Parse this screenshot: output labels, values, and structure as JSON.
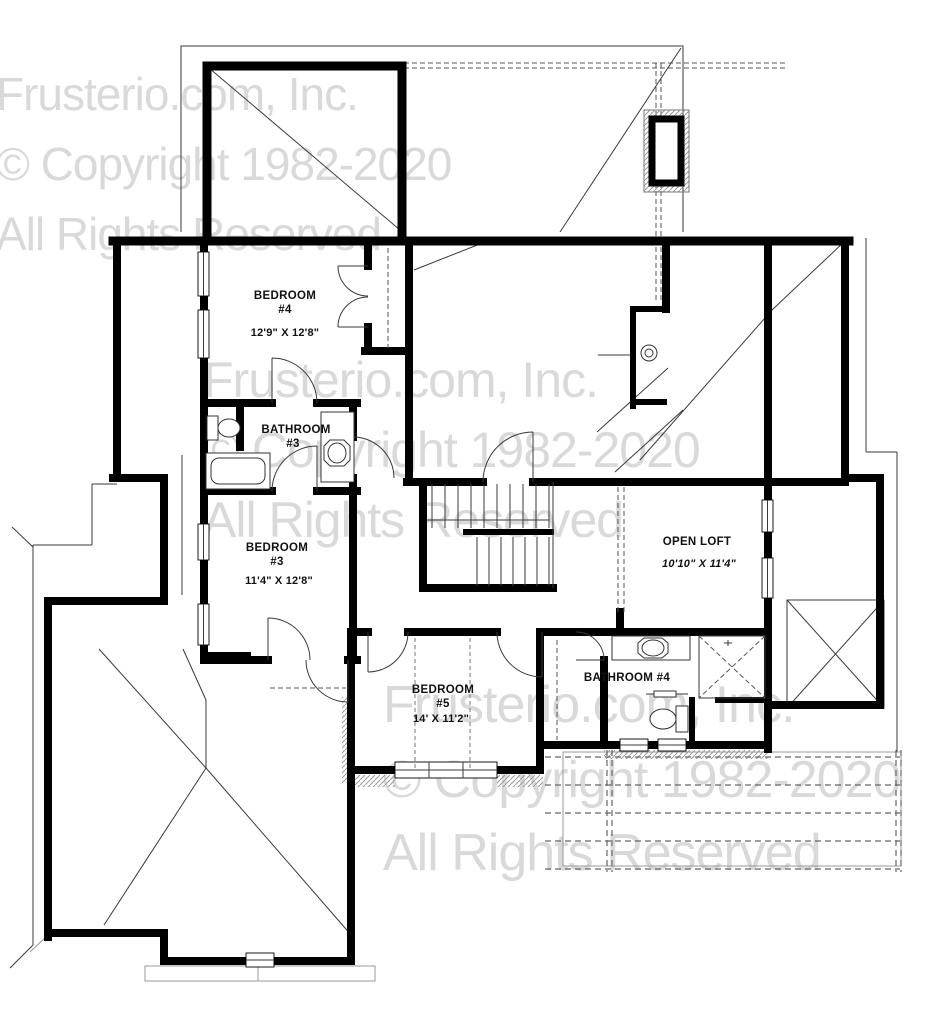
{
  "watermark": {
    "line1": "Frusterio.com, Inc.",
    "line2": "© Copyright 1982-2020",
    "line3": "All Rights Reserved",
    "color": "#d9d9d9"
  },
  "rooms": {
    "bedroom4": {
      "name_line1": "BEDROOM",
      "name_line2": "#4",
      "dims": "12'9\" X 12'8\""
    },
    "bathroom3": {
      "name_line1": "BATHROOM",
      "name_line2": "#3"
    },
    "bedroom3": {
      "name_line1": "BEDROOM",
      "name_line2": "#3",
      "dims": "11'4\" X 12'8\""
    },
    "open_loft": {
      "name_line1": "OPEN LOFT",
      "dims": "10'10\" X 11'4\""
    },
    "bathroom4": {
      "name_line1": "BATHROOM #4"
    },
    "bedroom5": {
      "name_line1": "BEDROOM",
      "name_line2": "#5",
      "dims": "14' X 11'2\""
    }
  },
  "colors": {
    "walls": "#000000",
    "thin_lines": "#3a3a3a",
    "watermark": "#d9d9d9",
    "background": "#ffffff"
  }
}
